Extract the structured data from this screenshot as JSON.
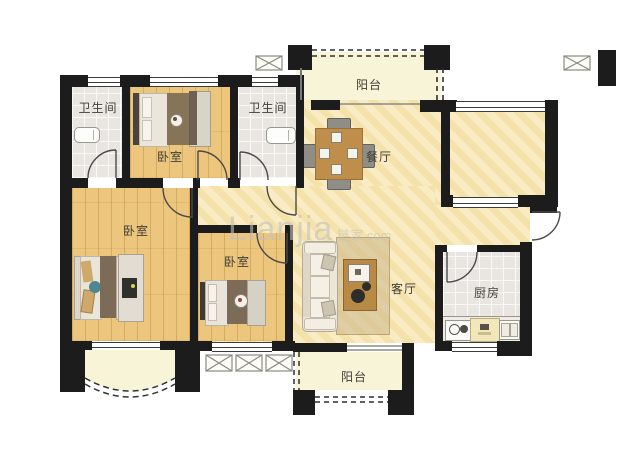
{
  "watermark": {
    "brand": "Lianjia",
    "domain": "链家.com"
  },
  "rooms": {
    "bathroom_left": {
      "label": "卫生间"
    },
    "bedroom_top": {
      "label": "卧室"
    },
    "bathroom_right": {
      "label": "卫生间"
    },
    "balcony_north": {
      "label": "阳台"
    },
    "dining": {
      "label": "餐厅"
    },
    "bedroom_master": {
      "label": "卧室"
    },
    "bedroom_middle": {
      "label": "卧室"
    },
    "living": {
      "label": "客厅"
    },
    "kitchen": {
      "label": "厨房"
    },
    "balcony_south": {
      "label": "阳台"
    }
  },
  "colors": {
    "wall": "#1c1c1c",
    "wood_floor": "#ecc67c",
    "open_floor": "#f5e2ab",
    "tile_floor": "#e9e6e1",
    "balcony_floor": "#f8f4d8",
    "label_text": "#3f3e37"
  }
}
